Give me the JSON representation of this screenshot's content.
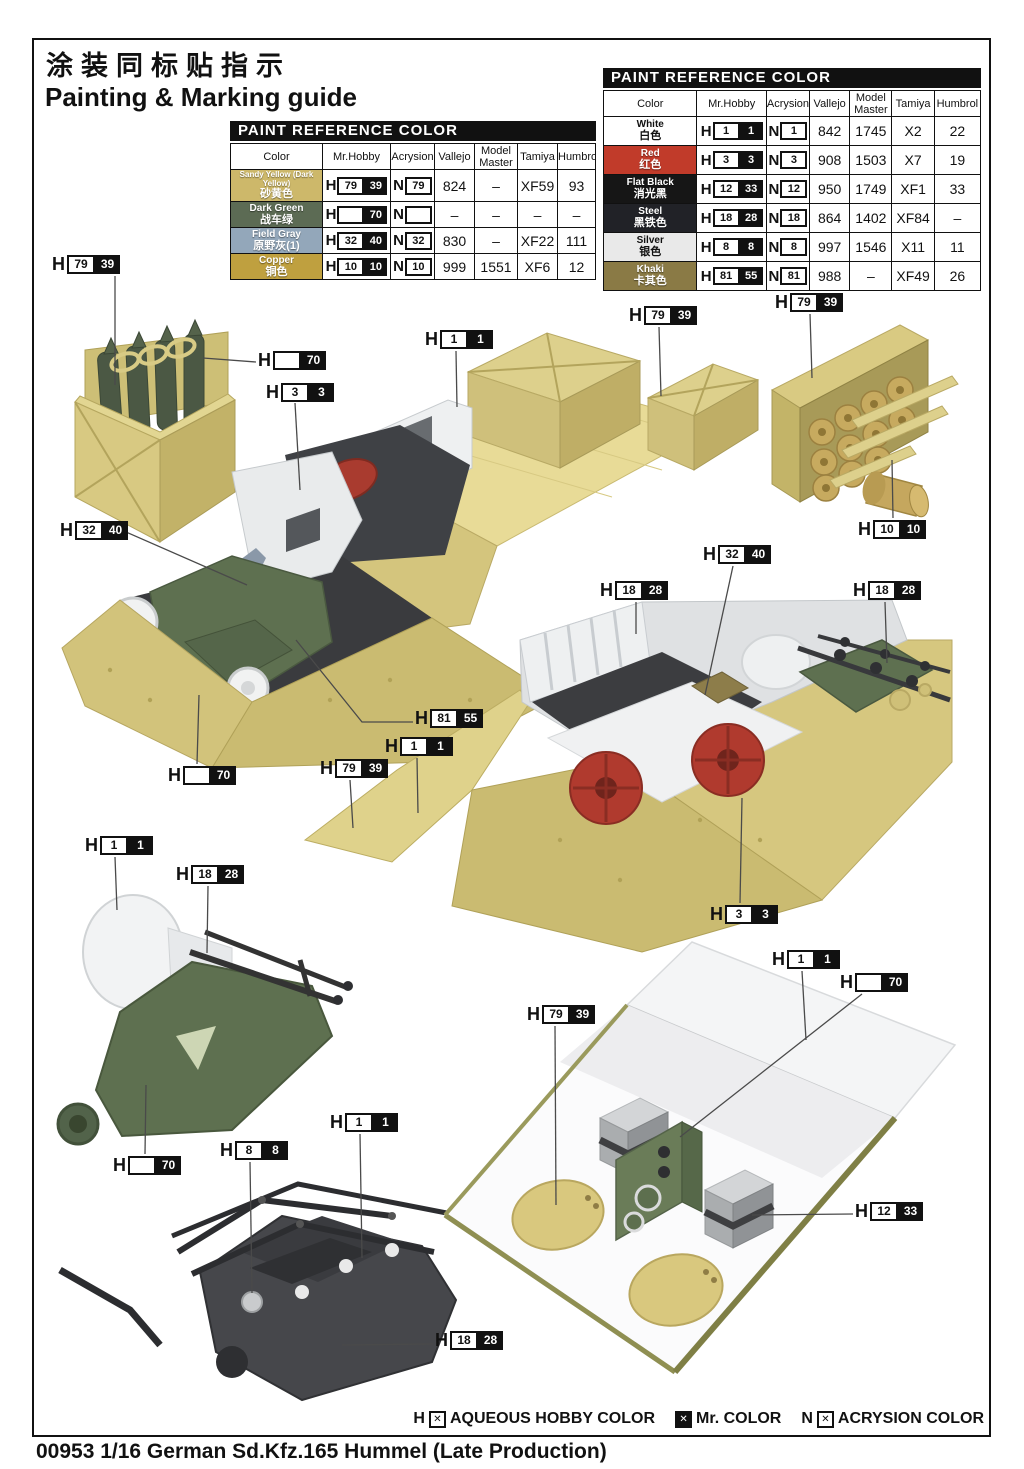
{
  "page": {
    "title_cn": "涂装同标贴指示",
    "title_en": "Painting & Marking guide",
    "footer_title": "00953 1/16  German Sd.Kfz.165 Hummel (Late Production)",
    "legend": {
      "aqueous_prefix": "H",
      "aqueous_label": "AQUEOUS HOBBY COLOR",
      "mr_label": "Mr. COLOR",
      "acrysion_prefix": "N",
      "acrysion_label": "ACRYSION COLOR",
      "box_glyph": "✕"
    }
  },
  "tables": [
    {
      "header": "PAINT  REFERENCE COLOR",
      "columns": [
        "Color",
        "Mr.Hobby",
        "Acrysion",
        "Vallejo",
        "Model Master",
        "Tamiya",
        "Humbrol"
      ],
      "rows": [
        {
          "name_en": "Sandy Yellow (Dark Yellow)",
          "name_cn": "砂黄色",
          "swatch": "#cdb86a",
          "text_color": "#ffffff",
          "h_box": "79",
          "h_solid": "39",
          "n_box": "79",
          "vallejo": "824",
          "model_master": "–",
          "tamiya": "XF59",
          "humbrol": "93"
        },
        {
          "name_en": "Dark Green",
          "name_cn": "战车绿",
          "swatch": "#5c6b54",
          "text_color": "#ffffff",
          "h_box": "",
          "h_solid": "70",
          "n_box": "",
          "vallejo": "–",
          "model_master": "–",
          "tamiya": "–",
          "humbrol": "–"
        },
        {
          "name_en": "Field Gray",
          "name_cn": "原野灰(1)",
          "swatch": "#93a7ba",
          "text_color": "#ffffff",
          "h_box": "32",
          "h_solid": "40",
          "n_box": "32",
          "vallejo": "830",
          "model_master": "–",
          "tamiya": "XF22",
          "humbrol": "111"
        },
        {
          "name_en": "Copper",
          "name_cn": "铜色",
          "swatch": "#bfa03f",
          "text_color": "#ffffff",
          "h_box": "10",
          "h_solid": "10",
          "n_box": "10",
          "vallejo": "999",
          "model_master": "1551",
          "tamiya": "XF6",
          "humbrol": "12"
        }
      ]
    },
    {
      "header": "PAINT  REFERENCE COLOR",
      "columns": [
        "Color",
        "Mr.Hobby",
        "Acrysion",
        "Vallejo",
        "Model Master",
        "Tamiya",
        "Humbrol"
      ],
      "rows": [
        {
          "name_en": "White",
          "name_cn": "白色",
          "swatch": "#ffffff",
          "text_color": "#111111",
          "h_box": "1",
          "h_solid": "1",
          "n_box": "1",
          "vallejo": "842",
          "model_master": "1745",
          "tamiya": "X2",
          "humbrol": "22"
        },
        {
          "name_en": "Red",
          "name_cn": "红色",
          "swatch": "#c13b2a",
          "text_color": "#ffffff",
          "h_box": "3",
          "h_solid": "3",
          "n_box": "3",
          "vallejo": "908",
          "model_master": "1503",
          "tamiya": "X7",
          "humbrol": "19"
        },
        {
          "name_en": "Flat Black",
          "name_cn": "消光黑",
          "swatch": "#161616",
          "text_color": "#ffffff",
          "h_box": "12",
          "h_solid": "33",
          "n_box": "12",
          "vallejo": "950",
          "model_master": "1749",
          "tamiya": "XF1",
          "humbrol": "33"
        },
        {
          "name_en": "Steel",
          "name_cn": "黑铁色",
          "swatch": "#212227",
          "text_color": "#ffffff",
          "h_box": "18",
          "h_solid": "28",
          "n_box": "18",
          "vallejo": "864",
          "model_master": "1402",
          "tamiya": "XF84",
          "humbrol": "–"
        },
        {
          "name_en": "Silver",
          "name_cn": "银色",
          "swatch": "#e9e9e9",
          "text_color": "#111111",
          "h_box": "8",
          "h_solid": "8",
          "n_box": "8",
          "vallejo": "997",
          "model_master": "1546",
          "tamiya": "X11",
          "humbrol": "11"
        },
        {
          "name_en": "Khaki",
          "name_cn": "卡其色",
          "swatch": "#8a7a45",
          "text_color": "#ffffff",
          "h_box": "81",
          "h_solid": "55",
          "n_box": "81",
          "vallejo": "988",
          "model_master": "–",
          "tamiya": "XF49",
          "humbrol": "26"
        }
      ]
    }
  ],
  "callouts": [
    {
      "box": "79",
      "solid": "39",
      "x": 52,
      "y": 255,
      "line": [
        [
          115,
          276
        ],
        [
          115,
          385
        ]
      ]
    },
    {
      "box": "",
      "solid": "70",
      "x": 258,
      "y": 351,
      "line": [
        [
          256,
          362
        ],
        [
          203,
          358
        ]
      ]
    },
    {
      "box": "3",
      "solid": "3",
      "x": 266,
      "y": 383,
      "line": [
        [
          295,
          403
        ],
        [
          300,
          490
        ]
      ]
    },
    {
      "box": "1",
      "solid": "1",
      "x": 425,
      "y": 330,
      "line": [
        [
          456,
          351
        ],
        [
          457,
          407
        ]
      ]
    },
    {
      "box": "79",
      "solid": "39",
      "x": 629,
      "y": 306,
      "line": [
        [
          659,
          327
        ],
        [
          661,
          396
        ]
      ]
    },
    {
      "box": "79",
      "solid": "39",
      "x": 775,
      "y": 293,
      "line": [
        [
          810,
          314
        ],
        [
          812,
          378
        ]
      ]
    },
    {
      "box": "32",
      "solid": "40",
      "x": 60,
      "y": 521,
      "line": [
        [
          126,
          532
        ],
        [
          247,
          585
        ]
      ]
    },
    {
      "box": "10",
      "solid": "10",
      "x": 858,
      "y": 520,
      "line": [
        [
          893,
          518
        ],
        [
          892,
          460
        ]
      ]
    },
    {
      "box": "32",
      "solid": "40",
      "x": 703,
      "y": 545,
      "line": [
        [
          733,
          566
        ],
        [
          705,
          695
        ]
      ]
    },
    {
      "box": "18",
      "solid": "28",
      "x": 600,
      "y": 581,
      "line": [
        [
          636,
          602
        ],
        [
          636,
          634
        ]
      ]
    },
    {
      "box": "18",
      "solid": "28",
      "x": 853,
      "y": 581,
      "line": [
        [
          885,
          602
        ],
        [
          887,
          663
        ]
      ]
    },
    {
      "box": "81",
      "solid": "55",
      "x": 415,
      "y": 709,
      "line": [
        [
          413,
          722
        ],
        [
          362,
          722
        ],
        [
          296,
          640
        ]
      ]
    },
    {
      "box": "1",
      "solid": "1",
      "x": 385,
      "y": 737,
      "line": [
        [
          417,
          758
        ],
        [
          418,
          813
        ]
      ]
    },
    {
      "box": "79",
      "solid": "39",
      "x": 320,
      "y": 759,
      "line": [
        [
          350,
          780
        ],
        [
          353,
          828
        ]
      ]
    },
    {
      "box": "",
      "solid": "70",
      "x": 168,
      "y": 766,
      "line": [
        [
          197,
          764
        ],
        [
          199,
          695
        ]
      ]
    },
    {
      "box": "1",
      "solid": "1",
      "x": 85,
      "y": 836,
      "line": [
        [
          115,
          857
        ],
        [
          117,
          910
        ]
      ]
    },
    {
      "box": "18",
      "solid": "28",
      "x": 176,
      "y": 865,
      "line": [
        [
          208,
          886
        ],
        [
          207,
          953
        ]
      ]
    },
    {
      "box": "3",
      "solid": "3",
      "x": 710,
      "y": 905,
      "line": [
        [
          740,
          903
        ],
        [
          742,
          798
        ]
      ]
    },
    {
      "box": "1",
      "solid": "1",
      "x": 772,
      "y": 950,
      "line": [
        [
          802,
          971
        ],
        [
          806,
          1040
        ]
      ]
    },
    {
      "box": "",
      "solid": "70",
      "x": 840,
      "y": 973,
      "line": [
        [
          862,
          994
        ],
        [
          680,
          1137
        ]
      ]
    },
    {
      "box": "79",
      "solid": "39",
      "x": 527,
      "y": 1005,
      "line": [
        [
          555,
          1026
        ],
        [
          556,
          1205
        ]
      ]
    },
    {
      "box": "1",
      "solid": "1",
      "x": 330,
      "y": 1113,
      "line": [
        [
          360,
          1134
        ],
        [
          362,
          1258
        ]
      ]
    },
    {
      "box": "8",
      "solid": "8",
      "x": 220,
      "y": 1141,
      "line": [
        [
          250,
          1162
        ],
        [
          252,
          1293
        ]
      ]
    },
    {
      "box": "",
      "solid": "70",
      "x": 113,
      "y": 1156,
      "line": [
        [
          145,
          1154
        ],
        [
          146,
          1085
        ]
      ]
    },
    {
      "box": "12",
      "solid": "33",
      "x": 855,
      "y": 1202,
      "line": [
        [
          853,
          1214
        ],
        [
          752,
          1215
        ]
      ]
    },
    {
      "box": "18",
      "solid": "28",
      "x": 435,
      "y": 1331,
      "line": [
        [
          433,
          1344
        ],
        [
          342,
          1345
        ]
      ]
    }
  ],
  "colors": {
    "sand": "#d2c37b",
    "sand_light": "#e8db97",
    "sand_dark": "#bfae66",
    "interior_white": "#eef0f1",
    "dark_part": "#3f4145",
    "green": "#5e7050",
    "red": "#b03a2e",
    "copper": "#c5a75e",
    "khaki_box": "#8d7d4a"
  }
}
